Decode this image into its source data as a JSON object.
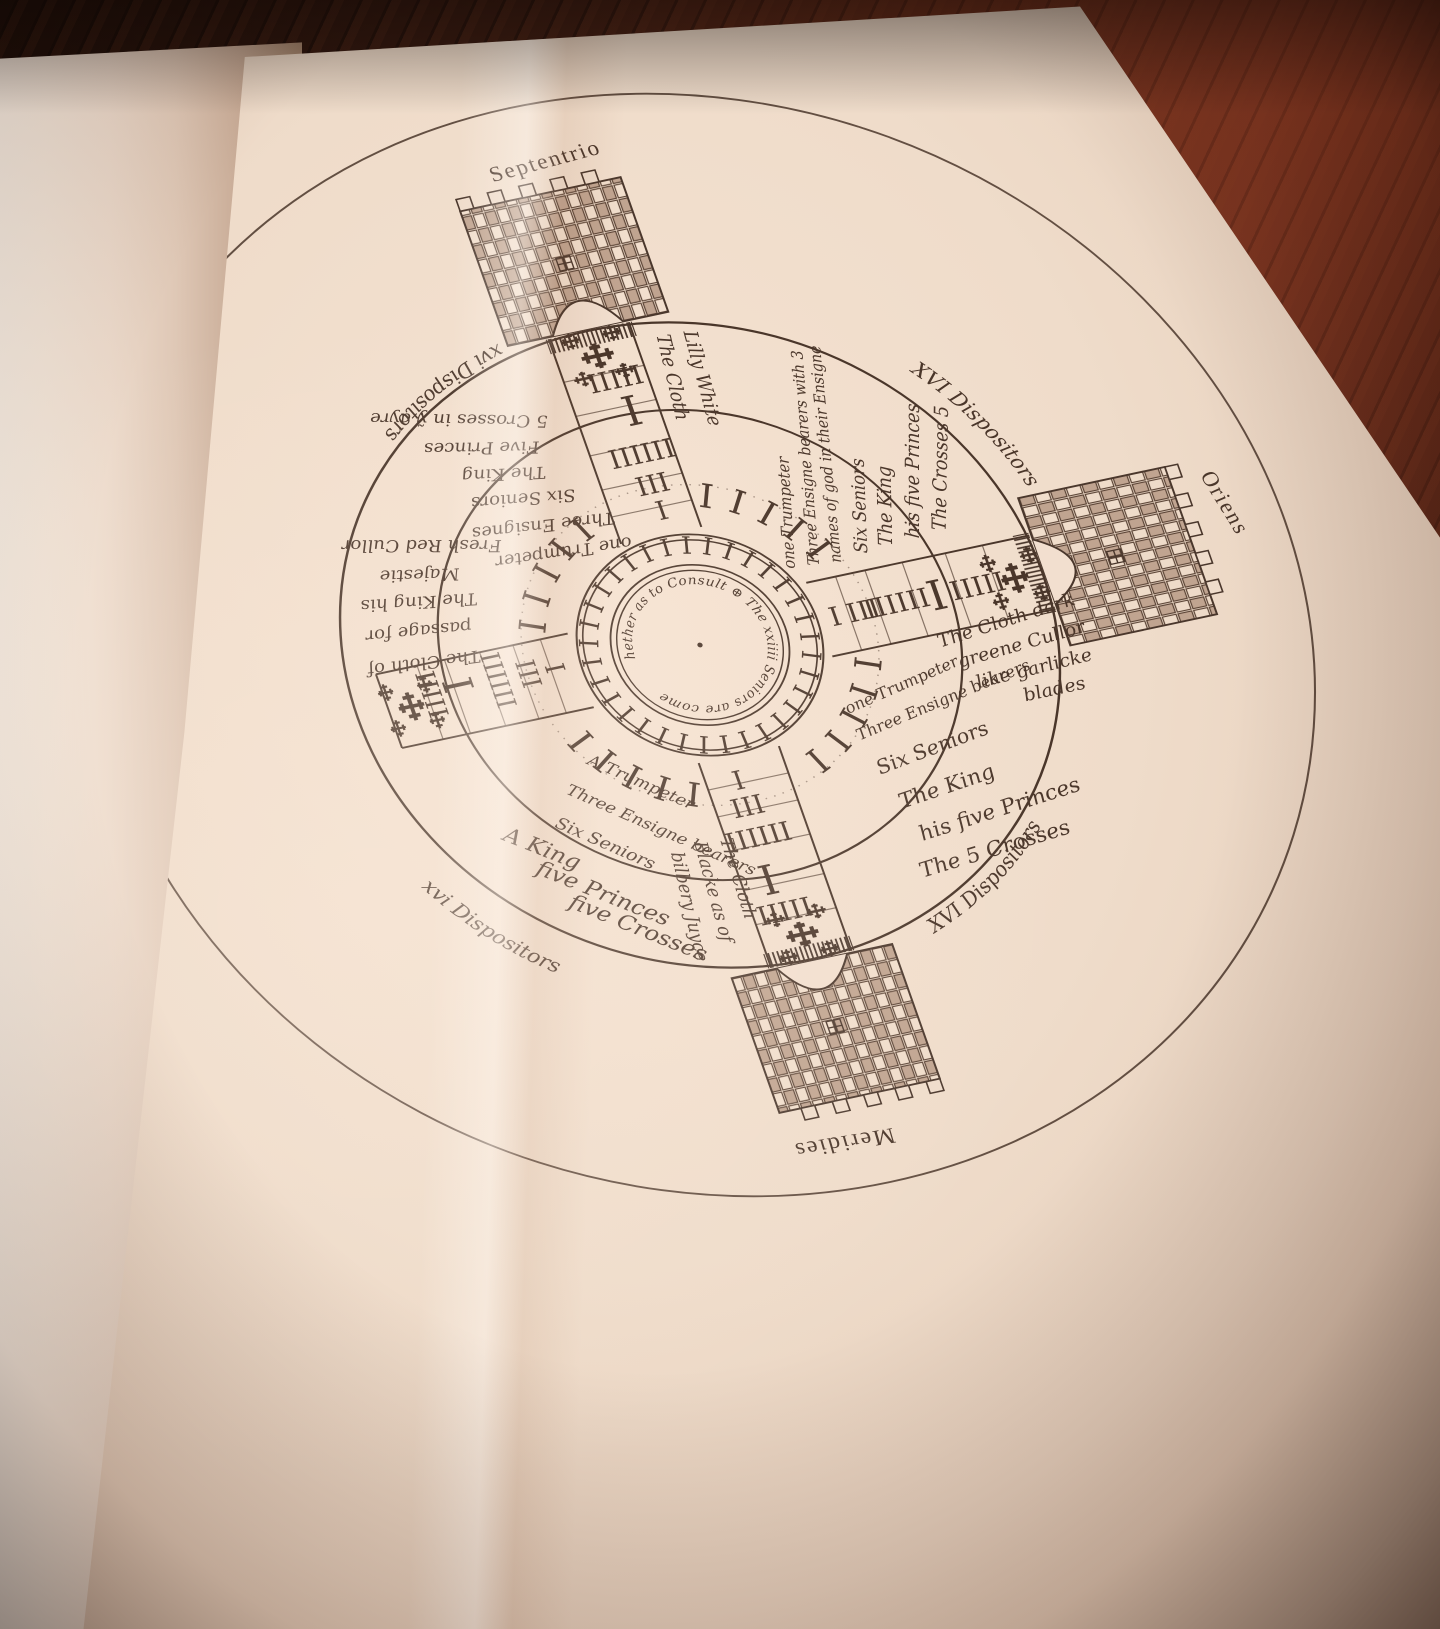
{
  "diagram": {
    "cardinal_labels": {
      "north": "Septentrio",
      "east": "Oriens",
      "south": "Meridies"
    },
    "center": {
      "motto": "hether as to Consult ⊕ The xxiiii Seniors are come",
      "ring_tallies": "IIIIIIIIIIIIIIIIIIIIIIIIIIIIIIIIIIII",
      "quarter_tallies": "IIIIII"
    },
    "arm_tallies": {
      "trumpeter": "I",
      "ensignes": "III",
      "seniors": "IIIIII",
      "king": "I",
      "princes": "IIIII"
    },
    "cloths": {
      "north": [
        "The Cloth",
        "Lilly White"
      ],
      "east": [
        "The Cloth dark",
        "greene Cullor",
        "like garlicke",
        "blades"
      ],
      "south": [
        "The Cloth",
        "Blacke as of",
        "bilbery Juyce"
      ],
      "west": [
        "The Cloth of",
        "passage for",
        "The King his",
        "Majestie",
        "Fresh Red Cullor"
      ]
    },
    "companies": {
      "northwest": [
        "5 Crosses in ỹ ayre",
        "Five Princes",
        "The King",
        "Six Seniors",
        "Three Ensignes",
        "one Trumpeter"
      ],
      "northeast": [
        "one Trumpeter",
        "Three Ensigne bearers with 3",
        "names of god in their Ensigne",
        "Six Seniors",
        "The King",
        "his five Princes",
        "The Crosses 5"
      ],
      "southeast": [
        "one Trumpeter",
        "Three Ensigne bearers",
        "Six Seniors",
        "The King",
        "his five Princes",
        "The 5 Crosses"
      ],
      "southwest_escort": [
        "A Trumpeter",
        "Three Ensigne bearers",
        "Six Seniors"
      ],
      "southwest_royal": [
        "A King",
        "five Princes",
        "five Crosses"
      ]
    },
    "dispositors": {
      "northeast": "XVI Dispositors",
      "southeast": "XVI Dispositors",
      "southwest": "xvi Dispositors",
      "northwest": "xvi Dispositors"
    }
  }
}
